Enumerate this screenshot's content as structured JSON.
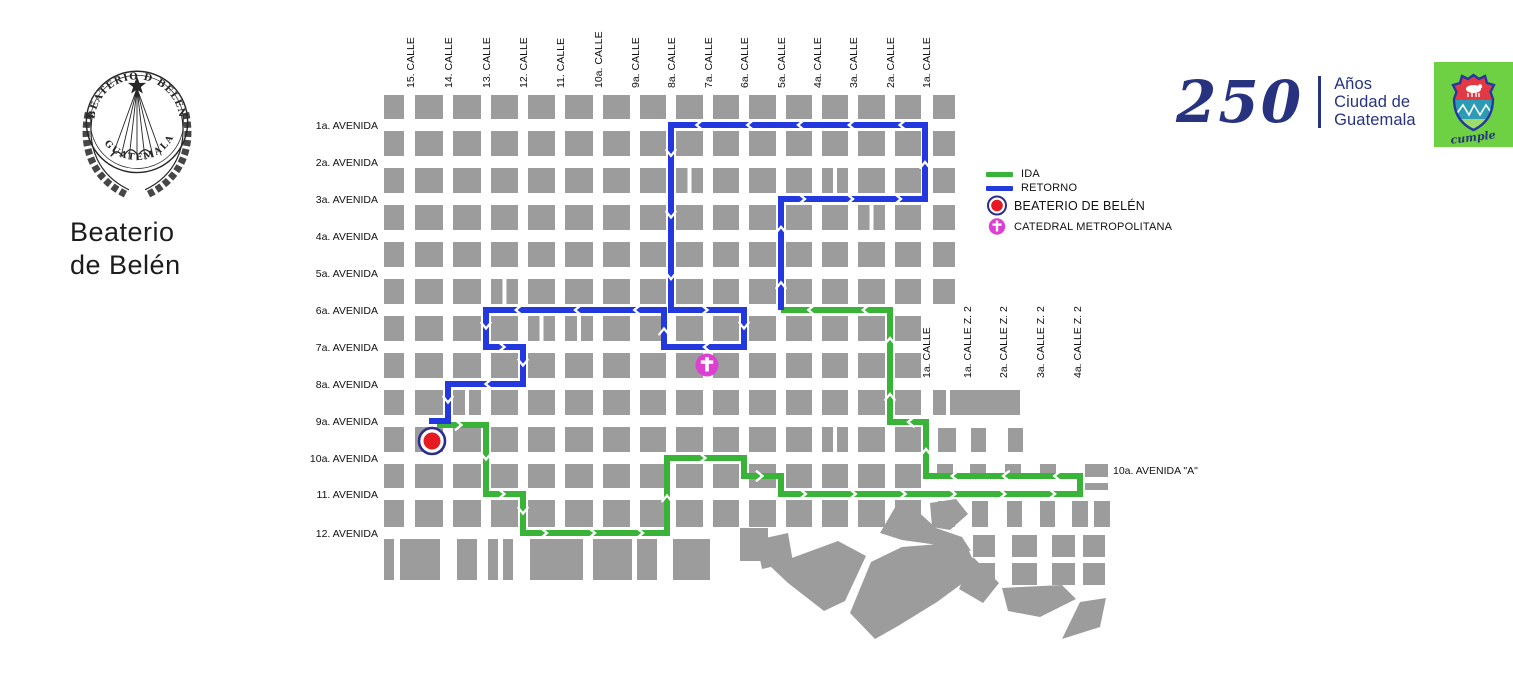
{
  "branding": {
    "org_line1": "Beaterio",
    "org_line2": "de Belén",
    "crest_top": "BEATERIO D BELEN",
    "crest_bottom": "GUATEMALA",
    "anniv_number": "250",
    "anniv_line1": "Años",
    "anniv_line2": "Ciudad de",
    "anniv_line3": "Guatemala",
    "badge_word": "cumple"
  },
  "legend": {
    "ida_label": "IDA",
    "retorno_label": "RETORNO",
    "beaterio_label": "BEATERIO DE BELÉN",
    "catedral_label": "CATEDRAL METROPOLITANA"
  },
  "map": {
    "colors": {
      "block": "#9C9C9C",
      "ida": "#3AB339",
      "retorno": "#2339DD",
      "marker_red": "#E51A23",
      "marker_ring": "#2B2E8C",
      "marker_magenta": "#DE3FD3",
      "label_text": "#111111"
    },
    "calle_labels": [
      {
        "text": "15. CALLE",
        "x": 410
      },
      {
        "text": "14. CALLE",
        "x": 448
      },
      {
        "text": "13. CALLE",
        "x": 486
      },
      {
        "text": "12. CALLE",
        "x": 523
      },
      {
        "text": "11. CALLE",
        "x": 560
      },
      {
        "text": "10a. CALLE",
        "x": 598
      },
      {
        "text": "9a. CALLE",
        "x": 635
      },
      {
        "text": "8a. CALLE",
        "x": 671
      },
      {
        "text": "7a. CALLE",
        "x": 708
      },
      {
        "text": "6a. CALLE",
        "x": 744
      },
      {
        "text": "5a. CALLE",
        "x": 781
      },
      {
        "text": "4a. CALLE",
        "x": 817
      },
      {
        "text": "3a. CALLE",
        "x": 853
      },
      {
        "text": "2a. CALLE",
        "x": 890
      },
      {
        "text": "1a. CALLE",
        "x": 926
      }
    ],
    "avenida_labels": [
      {
        "text": "1a. AVENIDA",
        "y": 125
      },
      {
        "text": "2a. AVENIDA",
        "y": 162
      },
      {
        "text": "3a. AVENIDA",
        "y": 199
      },
      {
        "text": "4a. AVENIDA",
        "y": 236
      },
      {
        "text": "5a. AVENIDA",
        "y": 273
      },
      {
        "text": "6a. AVENIDA",
        "y": 310
      },
      {
        "text": "7a. AVENIDA",
        "y": 347
      },
      {
        "text": "8a. AVENIDA",
        "y": 384
      },
      {
        "text": "9a. AVENIDA",
        "y": 421
      },
      {
        "text": "10a. AVENIDA",
        "y": 458
      },
      {
        "text": "11. AVENIDA",
        "y": 494
      },
      {
        "text": "12. AVENIDA",
        "y": 533
      }
    ],
    "zone2_calle_labels": [
      {
        "text": "1a. CALLE",
        "x": 926
      },
      {
        "text": "1a. CALLE Z. 2",
        "x": 967
      },
      {
        "text": "2a. CALLE Z. 2",
        "x": 1003
      },
      {
        "text": "3a. CALLE Z. 2",
        "x": 1040
      },
      {
        "text": "4a. CALLE Z. 2",
        "x": 1077
      }
    ],
    "east_avenue_label": {
      "text": "10a. AVENIDA \"A\"",
      "x": 1113,
      "y": 474
    },
    "routes": {
      "ida": {
        "label": "IDA",
        "color": "#3AB339",
        "points": [
          [
            437,
            425
          ],
          [
            486,
            425
          ],
          [
            486,
            494
          ],
          [
            523,
            494
          ],
          [
            523,
            533
          ],
          [
            667,
            533
          ],
          [
            667,
            458
          ],
          [
            744,
            458
          ],
          [
            744,
            476
          ],
          [
            781,
            476
          ],
          [
            781,
            494
          ],
          [
            1080,
            494
          ],
          [
            1080,
            476
          ],
          [
            926,
            476
          ],
          [
            926,
            422
          ],
          [
            890,
            422
          ],
          [
            890,
            310
          ],
          [
            781,
            310
          ]
        ]
      },
      "retorno": {
        "label": "RETORNO",
        "color": "#2339DD",
        "points": [
          [
            781,
            310
          ],
          [
            781,
            199
          ],
          [
            925,
            199
          ],
          [
            925,
            125
          ],
          [
            671,
            125
          ],
          [
            671,
            310
          ],
          [
            744,
            310
          ],
          [
            744,
            347
          ],
          [
            664,
            347
          ],
          [
            664,
            310
          ],
          [
            486,
            310
          ],
          [
            486,
            347
          ],
          [
            523,
            347
          ],
          [
            523,
            384
          ],
          [
            448,
            384
          ],
          [
            448,
            421
          ],
          [
            429,
            421
          ]
        ]
      }
    },
    "markers": {
      "beaterio": {
        "x": 432,
        "y": 441,
        "label": "BEATERIO DE BELÉN"
      },
      "catedral": {
        "x": 707,
        "y": 365,
        "label": "CATEDRAL METROPOLITANA"
      }
    },
    "grid": {
      "col_spans": [
        [
          384,
          404
        ],
        [
          415,
          443
        ],
        [
          453,
          481
        ],
        [
          491,
          518
        ],
        [
          528,
          555
        ],
        [
          565,
          593
        ],
        [
          603,
          630
        ],
        [
          640,
          666
        ],
        [
          676,
          703
        ],
        [
          713,
          739
        ],
        [
          749,
          776
        ],
        [
          786,
          812
        ],
        [
          822,
          848
        ],
        [
          858,
          885
        ],
        [
          895,
          921
        ],
        [
          933,
          955
        ]
      ],
      "row_spans": [
        [
          95,
          119
        ],
        [
          131,
          156
        ],
        [
          168,
          193
        ],
        [
          205,
          230
        ],
        [
          242,
          267
        ],
        [
          279,
          304
        ],
        [
          316,
          341
        ],
        [
          353,
          378
        ],
        [
          390,
          415
        ],
        [
          427,
          452
        ],
        [
          464,
          488
        ],
        [
          500,
          527
        ]
      ],
      "skip": [
        [
          6,
          15
        ],
        [
          7,
          15
        ],
        [
          8,
          15
        ],
        [
          9,
          15
        ],
        [
          10,
          15
        ],
        [
          11,
          15
        ]
      ],
      "split": [
        [
          2,
          8
        ],
        [
          2,
          12
        ],
        [
          3,
          13
        ],
        [
          5,
          3
        ],
        [
          6,
          4
        ],
        [
          6,
          5
        ],
        [
          8,
          2
        ],
        [
          9,
          12
        ]
      ],
      "extra_blocks": [
        [
          384,
          539,
          10,
          41
        ],
        [
          400,
          539,
          40,
          41
        ],
        [
          457,
          539,
          20,
          41
        ],
        [
          488,
          539,
          10,
          41
        ],
        [
          503,
          539,
          10,
          41
        ],
        [
          530,
          539,
          53,
          41
        ],
        [
          593,
          539,
          39,
          41
        ],
        [
          637,
          539,
          20,
          41
        ],
        [
          673,
          539,
          37,
          41
        ],
        [
          740,
          528,
          28,
          33
        ],
        [
          933,
          390,
          13,
          25
        ],
        [
          950,
          390,
          70,
          25
        ],
        [
          938,
          428,
          18,
          24
        ],
        [
          971,
          428,
          15,
          24
        ],
        [
          1008,
          428,
          15,
          24
        ],
        [
          937,
          464,
          16,
          13
        ],
        [
          970,
          464,
          16,
          13
        ],
        [
          1005,
          464,
          16,
          13
        ],
        [
          1040,
          464,
          16,
          13
        ],
        [
          1085,
          464,
          23,
          13
        ],
        [
          1085,
          483,
          23,
          7
        ],
        [
          938,
          501,
          17,
          26
        ],
        [
          972,
          501,
          16,
          26
        ],
        [
          1007,
          501,
          15,
          26
        ],
        [
          1040,
          501,
          15,
          26
        ],
        [
          1072,
          501,
          16,
          26
        ],
        [
          1094,
          501,
          16,
          26
        ],
        [
          973,
          535,
          22,
          22
        ],
        [
          1012,
          535,
          25,
          22
        ],
        [
          1052,
          535,
          23,
          22
        ],
        [
          1083,
          535,
          22,
          22
        ],
        [
          973,
          563,
          22,
          22
        ],
        [
          1012,
          563,
          25,
          22
        ],
        [
          1052,
          563,
          23,
          22
        ],
        [
          1083,
          563,
          22,
          22
        ]
      ],
      "polygons": [
        "756,540 788,533 793,562 762,569",
        "770,566 838,541 866,556 845,601 824,611 788,583",
        "880,533 897,504 913,507 936,528 962,537 971,551 938,545 902,540",
        "850,613 871,562 902,547 965,542 973,560 967,580 937,602 898,626 875,639",
        "973,557 999,583 983,603 959,589",
        "1002,588 1062,585 1076,599 1040,617 1008,611",
        "1080,602 1106,598 1100,627 1062,639",
        "930,503 956,499 968,514 950,530 932,527"
      ]
    }
  }
}
